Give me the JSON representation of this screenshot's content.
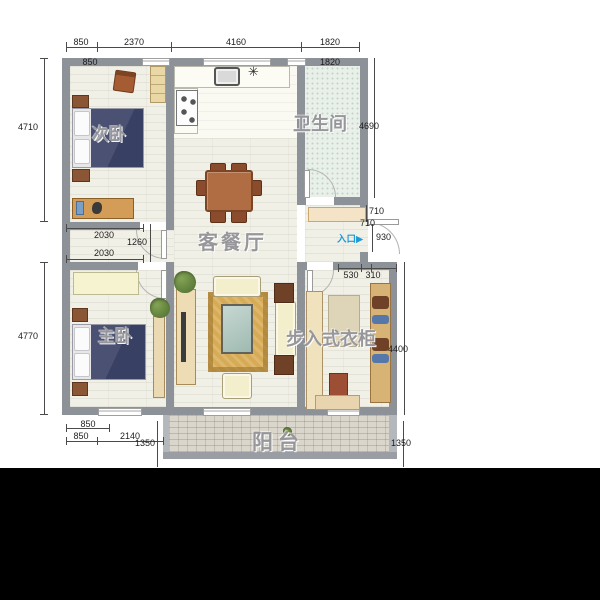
{
  "floorplan": {
    "rooms": {
      "secondary_bedroom": "次卧",
      "living_dining": "客餐厅",
      "bathroom": "卫生间",
      "master_bedroom": "主卧",
      "walk_in_closet": "步入式衣柜",
      "balcony": "阳台"
    },
    "entrance": {
      "label": "入口",
      "arrow": "▶"
    },
    "kitchen": {
      "hob_symbol": "✳"
    },
    "dimensions": {
      "top_outer": [
        "850",
        "2370",
        "4160",
        "1820"
      ],
      "top_inner_left": "850",
      "top_inner_right": "1820",
      "left_upper": "4710",
      "left_lower": "4770",
      "right_upper": "4690",
      "right_lower": "4400",
      "between_bedrooms_upper": "2030",
      "corridor_width": "1260",
      "between_bedrooms_lower": "2030",
      "entry_shelf_depth_a": "710",
      "entry_shelf_depth_b": "710",
      "entry_door_width": "930",
      "closet_top_left": "530",
      "closet_top_right": "310",
      "bottom_wall_segment": "850",
      "bottom_left_a": "850",
      "bottom_left_b": "2140",
      "balcony_depth_left": "1350",
      "balcony_depth_right": "1350"
    },
    "colors": {
      "wall": "#8d9198",
      "entrance_accent": "#1f9ad6",
      "bed": "#3b4263",
      "wood_furniture": "#a8633f",
      "sofa": "#f3eecb",
      "rug": "#d7ab55",
      "balcony_floor": "#dad6cc",
      "bathroom_tile": "#e9efe9",
      "letterbox": "#000000"
    }
  }
}
